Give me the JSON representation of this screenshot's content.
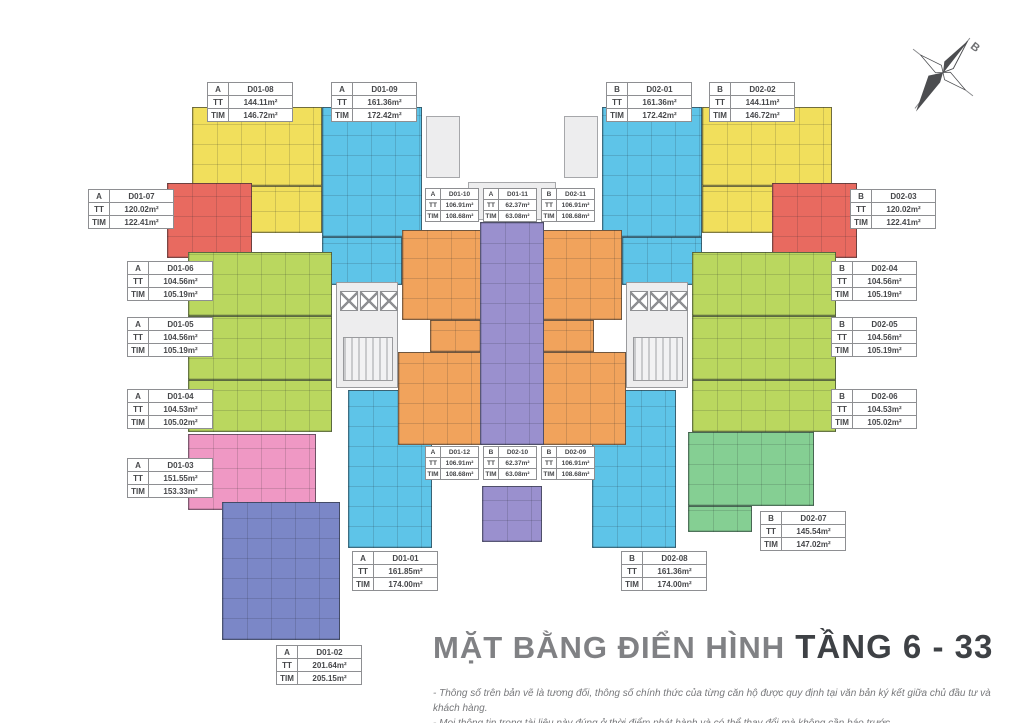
{
  "colors": {
    "yellow": "#f1df5c",
    "red": "#e86a60",
    "cyan": "#5ec4e8",
    "lime": "#bad75f",
    "orange": "#f1a35c",
    "purple": "#9a90ce",
    "pink": "#ef98c4",
    "periwinkle": "#7b87c7",
    "green": "#85cf93",
    "core": "#ededee"
  },
  "labels": {
    "tt": "TT",
    "tim": "TIM"
  },
  "compass": {
    "label": "B"
  },
  "title": {
    "regular": "MẶT BẰNG ĐIỂN HÌNH",
    "bold": " TẦNG 6 - 33"
  },
  "notes": [
    "- Thông số trên bản vẽ là tương đối, thông số chính thức của từng căn hộ được quy định tại văn bản ký kết giữa chủ đầu tư và khách hàng.",
    "- Mọi thông tin trong tài liệu này đúng ở thời điểm phát hành và có thể thay đổi mà không cần báo trước."
  ],
  "units": [
    {
      "wing": "A",
      "code": "D01-08",
      "tt": "144.11m²",
      "tim": "146.72m²",
      "color": "yellow"
    },
    {
      "wing": "A",
      "code": "D01-09",
      "tt": "161.36m²",
      "tim": "172.42m²",
      "color": "cyan"
    },
    {
      "wing": "B",
      "code": "D02-01",
      "tt": "161.36m²",
      "tim": "172.42m²",
      "color": "cyan"
    },
    {
      "wing": "B",
      "code": "D02-02",
      "tt": "144.11m²",
      "tim": "146.72m²",
      "color": "yellow"
    },
    {
      "wing": "A",
      "code": "D01-07",
      "tt": "120.02m²",
      "tim": "122.41m²",
      "color": "red"
    },
    {
      "wing": "A",
      "code": "D01-10",
      "tt": "106.91m²",
      "tim": "108.68m²",
      "color": "orange"
    },
    {
      "wing": "A",
      "code": "D01-11",
      "tt": "62.37m²",
      "tim": "63.08m²",
      "color": "purple"
    },
    {
      "wing": "B",
      "code": "D02-11",
      "tt": "106.91m²",
      "tim": "108.68m²",
      "color": "orange"
    },
    {
      "wing": "B",
      "code": "D02-03",
      "tt": "120.02m²",
      "tim": "122.41m²",
      "color": "red"
    },
    {
      "wing": "A",
      "code": "D01-06",
      "tt": "104.56m²",
      "tim": "105.19m²",
      "color": "lime"
    },
    {
      "wing": "B",
      "code": "D02-04",
      "tt": "104.56m²",
      "tim": "105.19m²",
      "color": "lime"
    },
    {
      "wing": "A",
      "code": "D01-05",
      "tt": "104.56m²",
      "tim": "105.19m²",
      "color": "lime"
    },
    {
      "wing": "B",
      "code": "D02-05",
      "tt": "104.56m²",
      "tim": "105.19m²",
      "color": "lime"
    },
    {
      "wing": "A",
      "code": "D01-04",
      "tt": "104.53m²",
      "tim": "105.02m²",
      "color": "lime"
    },
    {
      "wing": "B",
      "code": "D02-06",
      "tt": "104.53m²",
      "tim": "105.02m²",
      "color": "lime"
    },
    {
      "wing": "A",
      "code": "D01-03",
      "tt": "151.55m²",
      "tim": "153.33m²",
      "color": "pink"
    },
    {
      "wing": "A",
      "code": "D01-12",
      "tt": "106.91m²",
      "tim": "108.68m²",
      "color": "orange"
    },
    {
      "wing": "B",
      "code": "D02-10",
      "tt": "62.37m²",
      "tim": "63.08m²",
      "color": "purple"
    },
    {
      "wing": "B",
      "code": "D02-09",
      "tt": "106.91m²",
      "tim": "108.68m²",
      "color": "orange"
    },
    {
      "wing": "B",
      "code": "D02-07",
      "tt": "145.54m²",
      "tim": "147.02m²",
      "color": "green"
    },
    {
      "wing": "A",
      "code": "D01-01",
      "tt": "161.85m²",
      "tim": "174.00m²",
      "color": "cyan"
    },
    {
      "wing": "B",
      "code": "D02-08",
      "tt": "161.36m²",
      "tim": "174.00m²",
      "color": "cyan"
    },
    {
      "wing": "A",
      "code": "D01-02",
      "tt": "201.64m²",
      "tim": "205.15m²",
      "color": "periwinkle"
    }
  ]
}
